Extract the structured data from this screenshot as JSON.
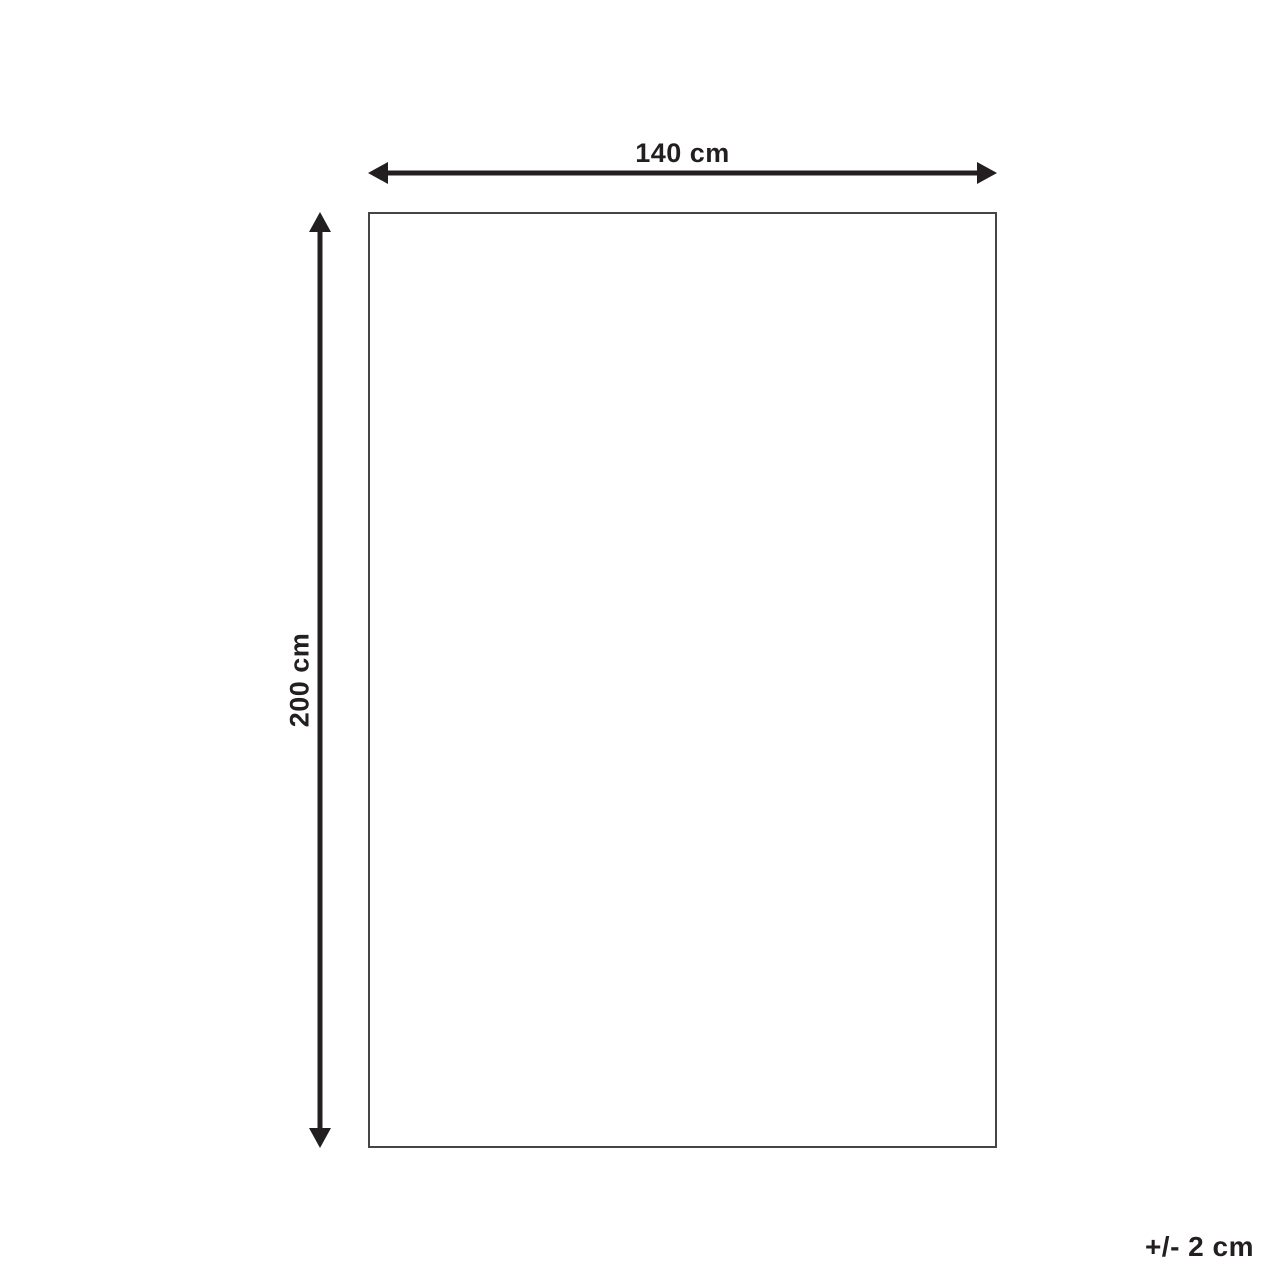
{
  "diagram": {
    "type": "product-dimension-diagram",
    "width_label": "140 cm",
    "height_label": "200 cm",
    "tolerance_label": "+/- 2 cm",
    "shape": "rectangle",
    "colors": {
      "background": "#ffffff",
      "arrow": "#231f20",
      "text": "#231f20",
      "rectangle_border": "#454545"
    }
  }
}
